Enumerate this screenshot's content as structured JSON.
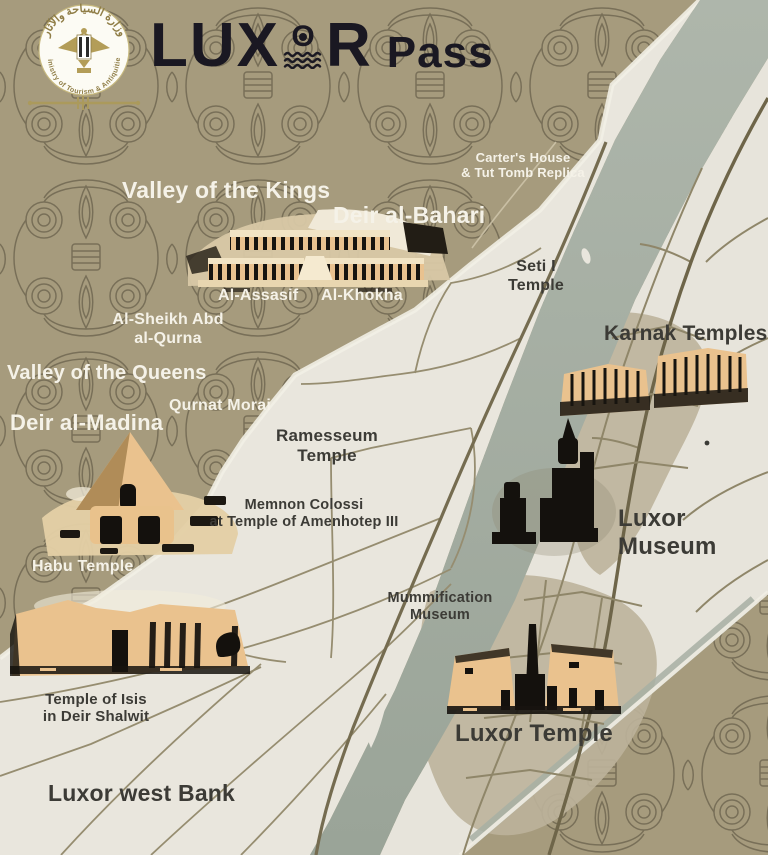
{
  "header": {
    "emblem": {
      "arabic_title": "وزارة السياحة والآثار",
      "english_title": "Ministry of Tourism & Antiquities"
    },
    "wordmark": {
      "lu": "LU",
      "x": "X",
      "o": "O",
      "r": "R",
      "suffix": "Pass"
    }
  },
  "map": {
    "labels": {
      "carters_house": {
        "line1": "Carter's House",
        "line2": "& Tut Tomb Replica"
      },
      "valley_of_the_kings": {
        "line1": "Valley of the Kings"
      },
      "deir_al_bahari": {
        "line1": "Deir al-Bahari"
      },
      "seti_temple": {
        "line1": "Seti I",
        "line2": "Temple"
      },
      "al_assasif": {
        "line1": "Al-Assasif"
      },
      "al_khokha": {
        "line1": "Al-Khokha"
      },
      "al_sheikh_abd": {
        "line1": "Al-Sheikh Abd",
        "line2": "al-Qurna"
      },
      "karnak_temples": {
        "line1": "Karnak Temples"
      },
      "valley_of_the_queens": {
        "line1": "Valley of the Queens"
      },
      "qurnat_morai": {
        "line1": "Qurnat Morai"
      },
      "deir_al_madina": {
        "line1": "Deir al-Madina"
      },
      "ramesseum_temple": {
        "line1": "Ramesseum",
        "line2": "Temple"
      },
      "memnon_colossi": {
        "line1": "Memnon Colossi",
        "line2": "at Temple of Amenhotep III"
      },
      "luxor_museum": {
        "line1": "Luxor",
        "line2": "Museum"
      },
      "habu_temple": {
        "line1": "Habu Temple"
      },
      "mummification_museum": {
        "line1": "Mummification",
        "line2": "Museum"
      },
      "temple_of_isis": {
        "line1": "Temple of Isis",
        "line2": "in Deir Shalwit"
      },
      "luxor_temple": {
        "line1": "Luxor Temple"
      },
      "luxor_west_bank": {
        "line1": "Luxor west Bank"
      }
    }
  },
  "colors": {
    "desert": "#a69b7d",
    "pattern_line": "#5c5440",
    "land_white": "#e9e6dd",
    "river": "#a4ada1",
    "road": "#968d70",
    "road_main": "#756c50",
    "city_shade": "#bcb39b",
    "temple_tan": "#eac28e",
    "temple_dark": "#17140f",
    "text_dark": "#3c3b36",
    "text_white": "#f5f2e8",
    "logo_gold": "#a7955a"
  }
}
